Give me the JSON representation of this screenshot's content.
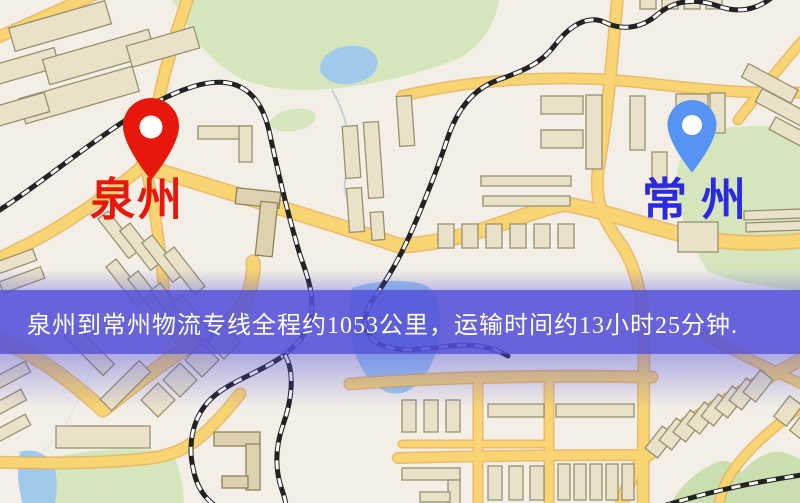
{
  "map": {
    "origin": {
      "name": "泉州",
      "pin_icon": "red-location-pin",
      "pin_color": "#e8170c",
      "label_color": "#e8170c"
    },
    "destination": {
      "name": "常州",
      "pin_icon": "blue-location-pin",
      "pin_color": "#5793f3",
      "label_color": "#2a2ae0"
    }
  },
  "banner": {
    "text": "泉州到常州物流专线全程约1053公里，运输时间约13小时25分钟.",
    "background_color": "#5250da",
    "text_color": "#ffffff"
  },
  "route": {
    "distance_text": "约1053公里",
    "duration_text": "约13小时25分钟"
  }
}
